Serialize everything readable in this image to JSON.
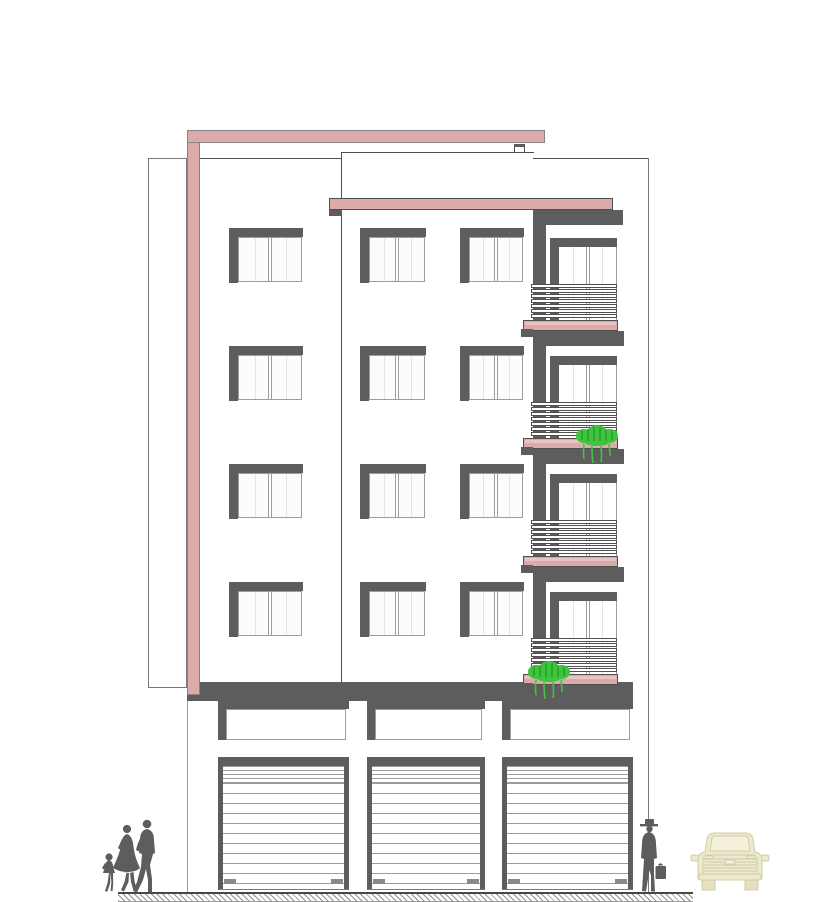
{
  "title": "Residential building street elevation drawing",
  "drawing_type": "architectural-front-elevation",
  "colors": {
    "paper": "#ffffff",
    "accent_pink": "#dbaaaa",
    "accent_pink_light": "#e9c2c2",
    "dark_gray": "#5d5d5d",
    "outline_dark": "#4f4f4f",
    "outline_mid": "#787878",
    "outline_light": "#9d9d9d",
    "glass_white": "#fcfcfc",
    "pane_hint": "#e4e4e4",
    "plant_green": "#3fc43f",
    "plant_green_dark": "#1f8a1f",
    "car_body": "#ede9cf",
    "car_detail": "#f4f0da",
    "car_outline": "#d2ccaa",
    "figure_gray": "#5d5d5d",
    "hatch_gray": "#8f8f8f"
  },
  "facade": {
    "upper_floors": 4,
    "window_rows_y": [
      228,
      346,
      464,
      582
    ],
    "window_height": 55,
    "left_wing_columns": [
      {
        "x": 229,
        "w": 74
      }
    ],
    "tower_columns": [
      {
        "x": 360,
        "w": 66
      },
      {
        "x": 460,
        "w": 64
      }
    ]
  },
  "balconies": {
    "count": 4,
    "floor_pitch": 118,
    "first_window_y": 238,
    "first_railing_y": 284,
    "first_slab_y": 320,
    "railing_bar_count": 7,
    "plants": [
      {
        "floor": 2,
        "x": 574,
        "y": 422
      },
      {
        "floor": 4,
        "x": 526,
        "y": 658
      }
    ]
  },
  "ground_floor": {
    "shop_count": 3,
    "shops": [
      {
        "x": 218,
        "w": 131
      },
      {
        "x": 367,
        "w": 118
      },
      {
        "x": 502,
        "w": 131
      }
    ]
  },
  "street": {
    "figures_left": [
      "child",
      "woman",
      "man"
    ],
    "figure_right": "man-with-briefcase-and-hat",
    "vehicle": "car-front-view"
  }
}
